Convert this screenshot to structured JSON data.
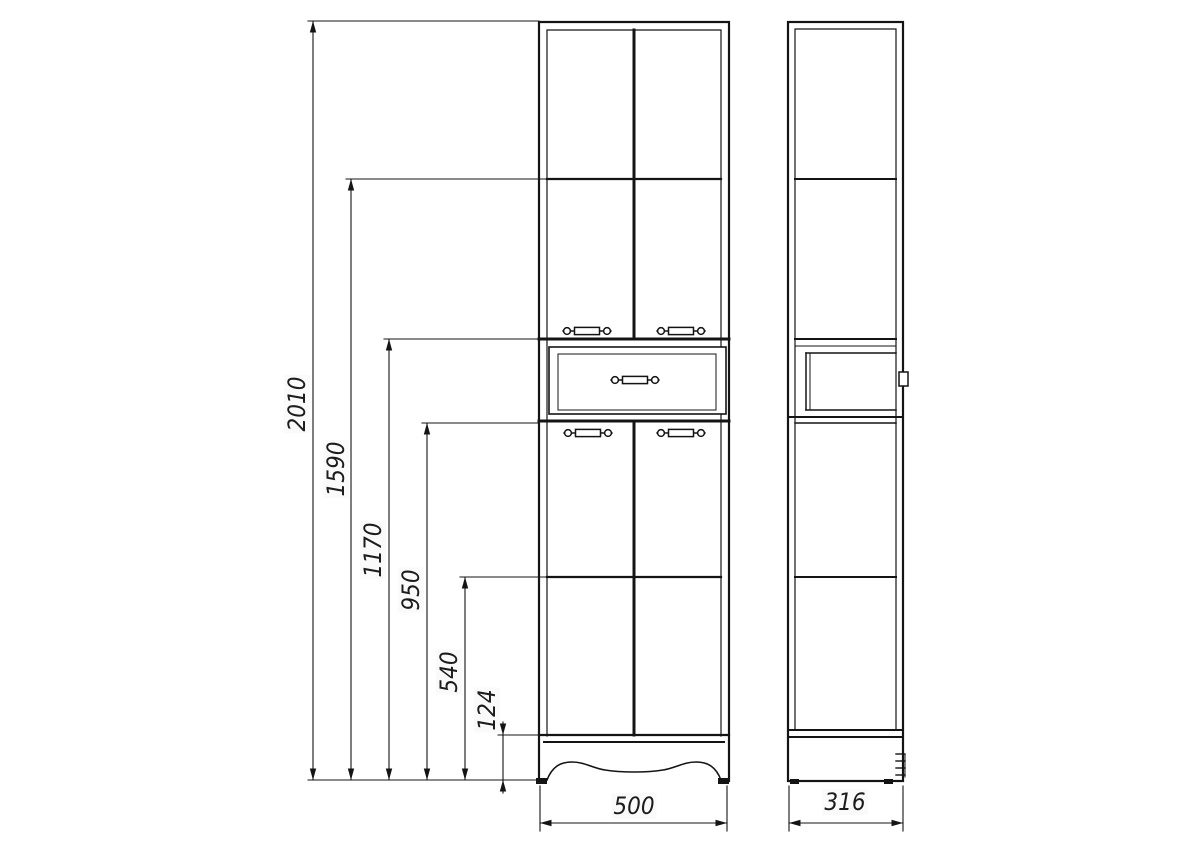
{
  "drawing": {
    "background_color": "#ffffff",
    "line_color": "#141414",
    "views": [
      "front-elevation",
      "side-elevation"
    ],
    "dimensions": {
      "heights": [
        "2010",
        "1590",
        "1170",
        "950",
        "540",
        "124"
      ],
      "front_width": "500",
      "side_depth": "316"
    }
  }
}
